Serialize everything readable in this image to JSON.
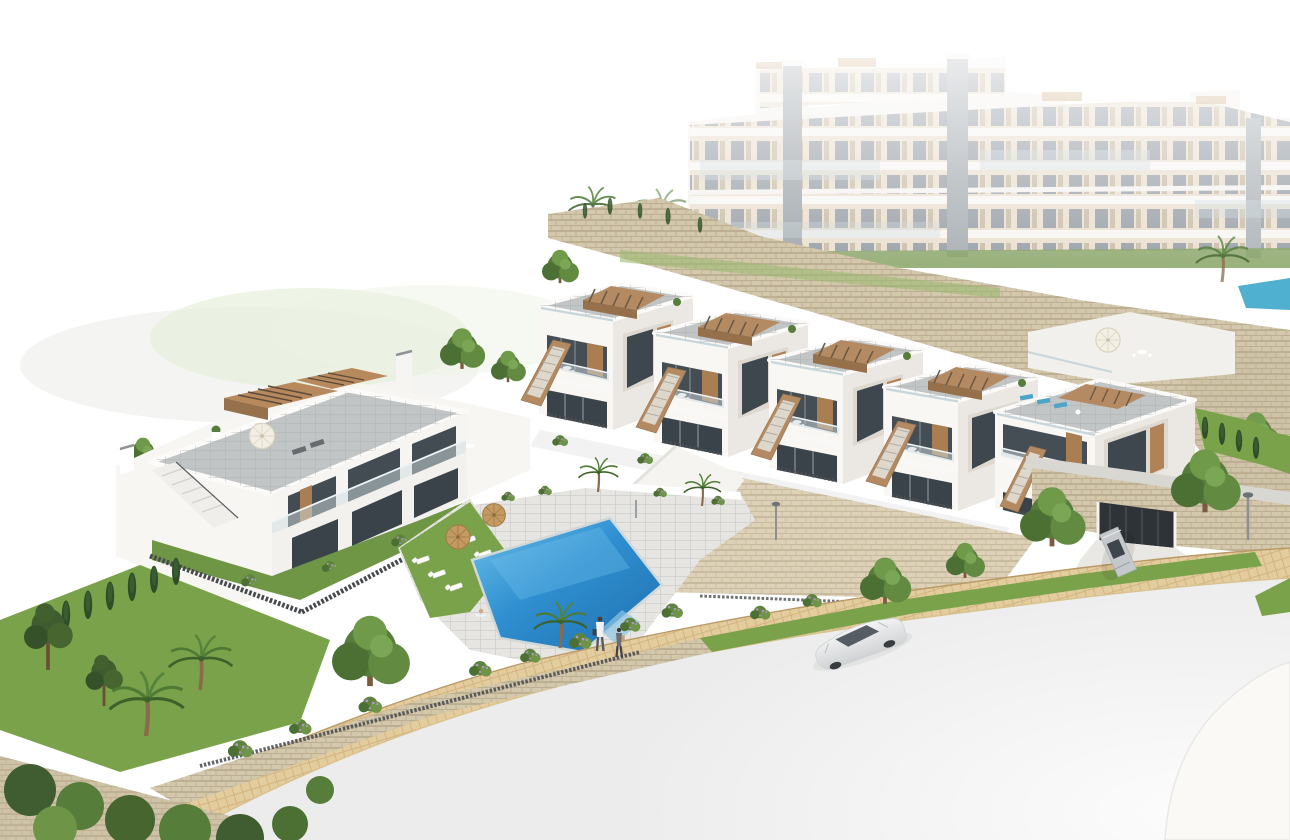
{
  "meta": {
    "title": "Aerial architectural render of a hillside residential development",
    "style": "3D visualization, pure white background, soft haze over background blocks",
    "visible_text": "none"
  },
  "palette": {
    "background": "#ffffff",
    "haze_green": "#e3eed7",
    "haze_gray": "#ebebe8",
    "building_white": "#f8f7f4",
    "building_shadow": "#ebe8e3",
    "roof_paver": "#c2c5c5",
    "wood_accent": "#b48a62",
    "wood_dark": "#95704a",
    "glass_dark": "#3f474e",
    "glass_balustrade": "#c8d6dc",
    "stone_wall": "#d3c7ac",
    "stone_joint": "#b7a98c",
    "cobble_path": "#e3cd9e",
    "pool_water": "#2f8fd0",
    "pool_water_light": "#72c1ea",
    "bg_pool_teal": "#55b6d3",
    "lawn_green": "#7aa24a",
    "lawn_pale": "#9cba70",
    "tree_green": "#567d3a",
    "tree_dark": "#3c5a2e",
    "flower_lilac": "#b297c4",
    "umbrella_straw": "#c49a62",
    "umbrella_white": "#f3efe4",
    "fence_dark": "#46494d",
    "road_gray": "#ececec",
    "car_white": "#eceded",
    "car_silver": "#c6c9cc",
    "metal_gray": "#8b9094"
  },
  "scene": {
    "sky": "plain white, no horizon",
    "background": {
      "apartment_complex": {
        "blocks": 3,
        "appearance": "hazy white multi-storey blocks fading to white at top",
        "features": [
          "beige window bands",
          "dark recessed windows",
          "gray elevator towers",
          "glass balconies",
          "tan rooftop pergolas"
        ],
        "amenities": [
          "small turquoise pool at left",
          "small turquoise pool at far right",
          "palm trees",
          "hedge strip at base"
        ]
      },
      "hillside": "beige stone retaining walls terracing down from the apartments"
    },
    "midground": {
      "townhouse_row": {
        "units": 5,
        "description": "white cubic townhouses stepping downhill to the right",
        "features": [
          "gray paver roof terraces with glass balustrades",
          "brown slatted pergolas",
          "brown stair parapets with light steps",
          "two dark-glass terrace levels",
          "wood door panels",
          "white terrace furniture",
          "rooftop plants"
        ]
      },
      "corner_unit": {
        "features": [
          "wrap-around facade",
          "three blue rooftop loungers",
          "large dark corner window",
          "side lawn with cypress trees"
        ]
      },
      "left_block": {
        "features": [
          "large gray roof terrace",
          "two brown slatted pergolas",
          "white parasol with loungers",
          "white dining set on terrace",
          "white external stair",
          "two chimneys",
          "front garden with dark slat fence"
        ]
      },
      "white_roof_terrace_behind_corner": [
        "cream parasol",
        "glass balustrade"
      ]
    },
    "foreground": {
      "courtyard": {
        "pool": "rhomboid blue communal pool with light rim",
        "straw_umbrellas": 2,
        "sun_loungers": 6,
        "lawn": "bright green lounging strip",
        "planters": "white boxes with tropical plants and two palms",
        "shower_post": 1
      },
      "swimmer_in_pool": 1,
      "pedestrians": [
        {
          "description": "adult in white shirt, gray trousers, dark bag"
        },
        {
          "description": "smaller person in dark top with tan backpack"
        }
      ],
      "street": {
        "sidewalk": "tan cobblestone band curving from lower-left to mid-right",
        "road": "pale gray, mostly blank, fading white to bottom-right",
        "traffic_island": "faint white rounded wedge at bottom-right",
        "street_lamps": 2
      },
      "cars": [
        {
          "type": "sedan",
          "color": "white",
          "location": "on road, lower middle"
        },
        {
          "type": "coupe",
          "color": "silver",
          "location": "garage driveway at right"
        }
      ],
      "garage": {
        "door": "dark opening in beige stone wall under corner unit"
      },
      "vegetation": [
        "tall pines at far left",
        "palm trees",
        "cypress hedge rows",
        "round canopy trees",
        "flowering shrubs with lilac blooms",
        "dense shrub bank at bottom-left"
      ]
    }
  },
  "inventory": {
    "townhouse_units_mid_row": 5,
    "corner_unit": 1,
    "left_duplex_block": 1,
    "background_apartment_blocks": 3,
    "pools_total": 3,
    "straw_umbrellas": 2,
    "white_parasols": 2,
    "sun_loungers_courtyard": 6,
    "rooftop_blue_loungers": 3,
    "pedestrians": 2,
    "swimmer": 1,
    "cars": 2,
    "street_lamps": 2,
    "garage_entrances": 1
  }
}
